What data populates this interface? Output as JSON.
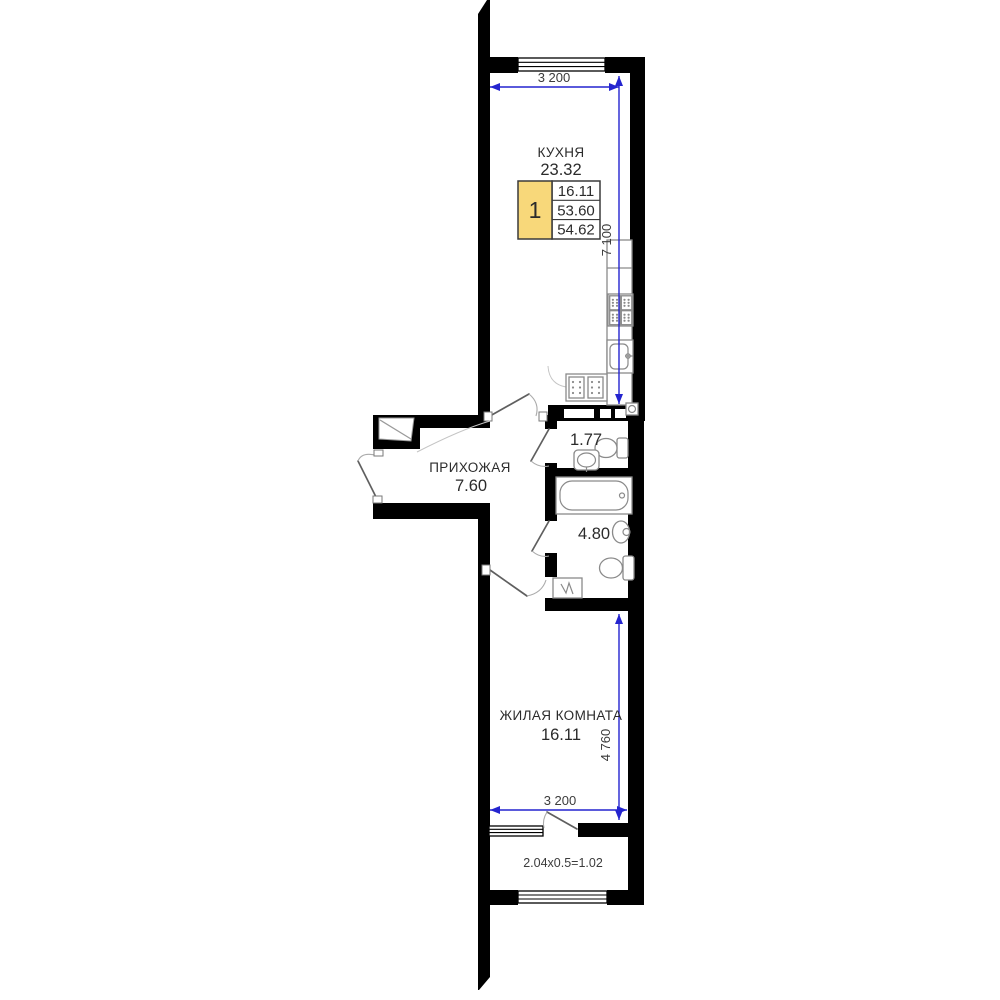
{
  "rooms": {
    "kitchen": {
      "name": "КУХНЯ",
      "area": "23.32"
    },
    "hallway": {
      "name": "ПРИХОЖАЯ",
      "area": "7.60"
    },
    "wc": {
      "area": "1.77"
    },
    "bathroom": {
      "area": "4.80"
    },
    "living_room": {
      "name": "ЖИЛАЯ КОМНАТА",
      "area": "16.11"
    },
    "balcony": {
      "calculation": "2.04x0.5=1.02"
    }
  },
  "info_table": {
    "rooms_count": "1",
    "rows": [
      "16.11",
      "53.60",
      "54.62"
    ]
  },
  "dimensions": {
    "top_width": "3 200",
    "kitchen_depth": "7 100",
    "room_depth": "4 760",
    "bottom_width": "3 200"
  },
  "colors": {
    "wall": "#000000",
    "dimension_line": "#2424cf",
    "table_highlight": "#f8d87a",
    "fixture_outline": "#8a8a8a"
  }
}
